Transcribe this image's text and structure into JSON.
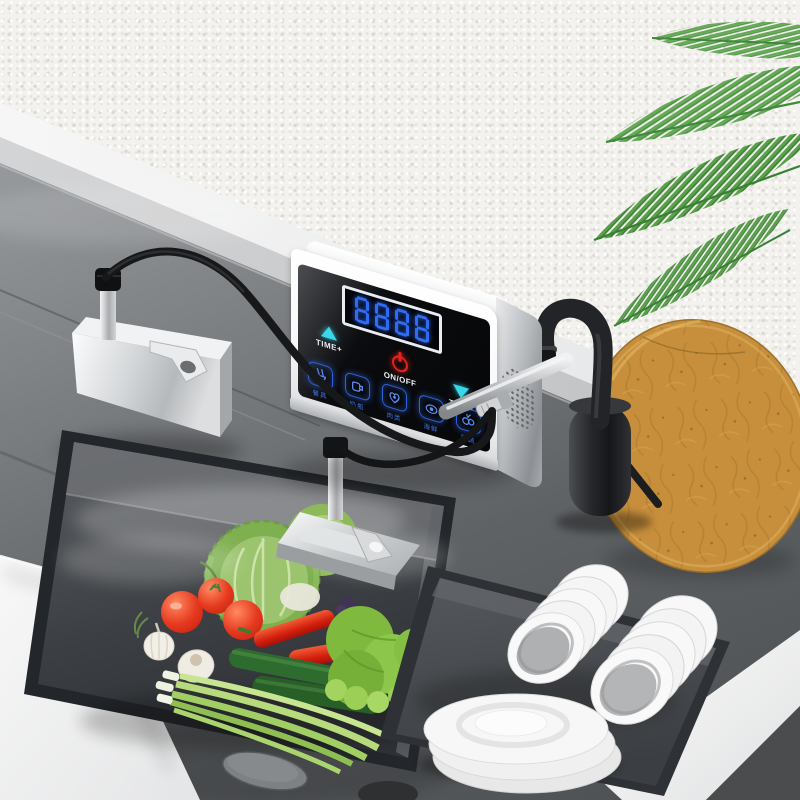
{
  "panel": {
    "display_value": "8888",
    "buttons": {
      "time_plus": "TIME+",
      "power": "ON/OFF",
      "time_minus": "TIME-"
    },
    "modes": [
      {
        "icon": "tableware-icon",
        "label": "餐具"
      },
      {
        "icon": "baby-bottle-icon",
        "label": "奶瓶"
      },
      {
        "icon": "meat-icon",
        "label": "肉类"
      },
      {
        "icon": "seafood-icon",
        "label": "海鲜"
      },
      {
        "icon": "fruit-vegetable-icon",
        "label": "果蔬"
      }
    ],
    "colors": {
      "digits": "#2e6cf5",
      "arrows": "#38d8e8",
      "power": "#ea1f1a",
      "mode_glow": "#2f63d8",
      "screen": "#0b0c0f",
      "body": "#fafbfc"
    }
  },
  "scene": {
    "objects": [
      "textured-white-wall",
      "palm-fronds",
      "window-ledge",
      "gray-countertop",
      "ultrasonic-generator-box",
      "touch-control-unit",
      "black-pullout-faucet",
      "oval-wooden-cutting-board",
      "sink-basin-with-vegetables",
      "submerged-transducer-plate",
      "dish-tray-with-bowls-and-plates",
      "drain-control-button",
      "power-cables"
    ],
    "colors": {
      "wall": "#f3f2ee",
      "counter": "#5f6265",
      "basin": "#3c3f43",
      "wood": "#c78f3c",
      "palm": "#66aa57",
      "faucet": "#26282b",
      "dishes": "#f7f7f7"
    }
  }
}
